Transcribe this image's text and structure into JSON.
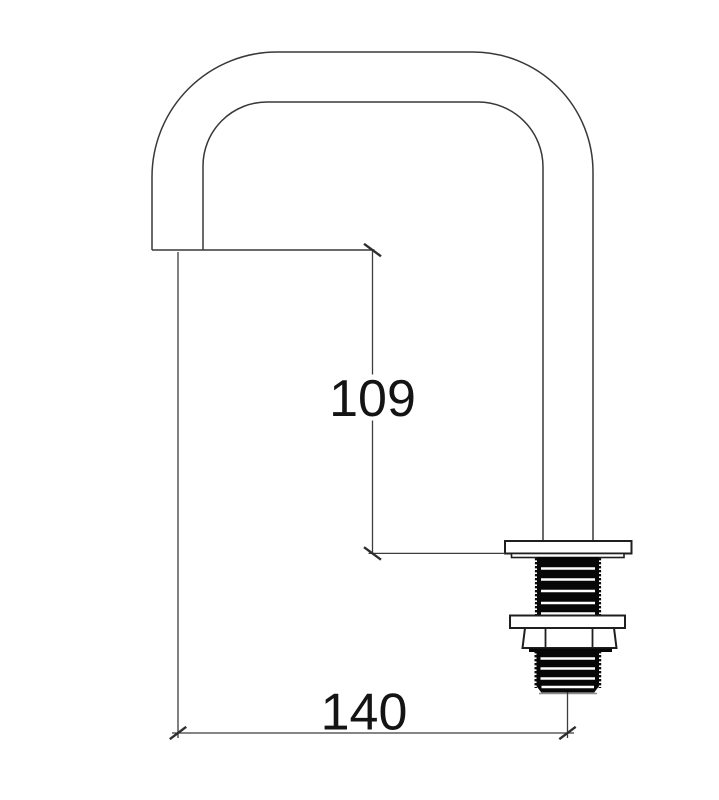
{
  "drawing": {
    "type": "technical-drawing",
    "subject": "faucet-spout-side-elevation",
    "background_color": "#ffffff",
    "line_color": "#383838",
    "thread_fill_color": "#070707",
    "text_color": "#141414",
    "dimensions": [
      {
        "id": "spout-height",
        "label": "109",
        "orientation": "vertical"
      },
      {
        "id": "spout-reach",
        "label": "140",
        "orientation": "horizontal"
      }
    ]
  }
}
